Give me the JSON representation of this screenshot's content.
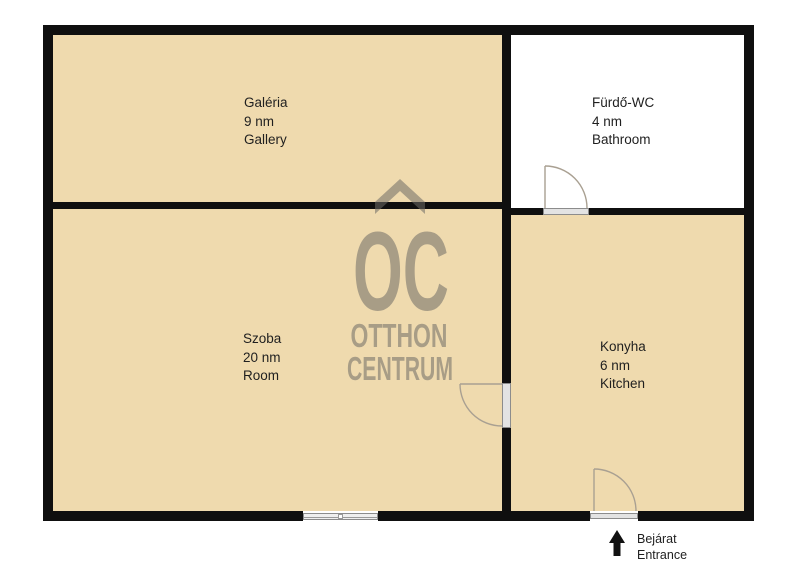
{
  "watermark": {
    "monogram": "OC",
    "brand_line1": "OTTHON",
    "brand_line2": "CENTRUM"
  },
  "rooms": {
    "gallery": {
      "name": "Galéria",
      "area": "9 nm",
      "name_en": "Gallery"
    },
    "bathroom": {
      "name": "Fürdő-WC",
      "area": "4 nm",
      "name_en": "Bathroom"
    },
    "room": {
      "name": "Szoba",
      "area": "20 nm",
      "name_en": "Room"
    },
    "kitchen": {
      "name": "Konyha",
      "area": "6 nm",
      "name_en": "Kitchen"
    }
  },
  "entrance": {
    "name": "Bejárat",
    "name_en": "Entrance"
  },
  "colors": {
    "room_fill": "#efdaae",
    "bathroom_fill": "#ffffff",
    "wall": "#0f0f0f",
    "watermark": "#6f6c67",
    "door_stroke": "#a9a092",
    "threshold_fill": "#e3e3e3",
    "threshold_border": "#8c8c8c",
    "text": "#1f1f1f"
  }
}
